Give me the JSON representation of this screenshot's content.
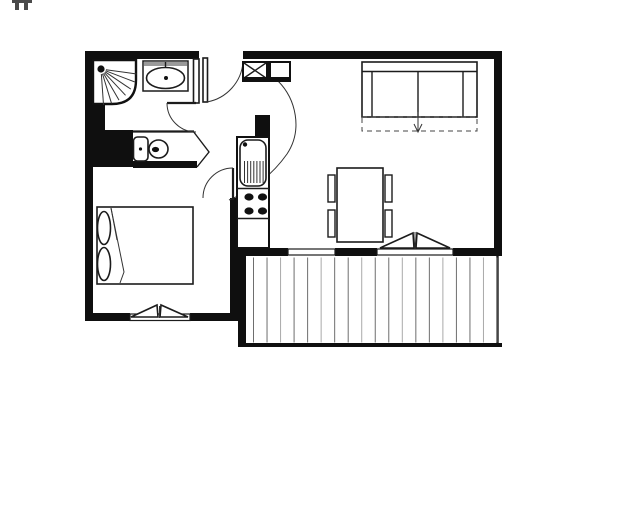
{
  "canvas": {
    "width": 640,
    "height": 524,
    "background": "#ffffff"
  },
  "palette": {
    "wall": "#0f0f0f",
    "line": "#1c1c1c",
    "soft_gray": "#8f8f8f",
    "board_dark": "#6e6e6e",
    "board_light": "#a9a9a9"
  },
  "corner_mark": {
    "present": true,
    "color": "#4a4a4a"
  },
  "plan": {
    "type": "apartment-floor-plan",
    "fixtures": [
      "shower",
      "washbasin",
      "toilet",
      "wardrobe",
      "entrance-door",
      "kitchen-sink",
      "stove",
      "counter",
      "sofa-bed",
      "dining-table",
      "chairs",
      "double-bed",
      "pillows",
      "casement-window",
      "french-door",
      "fixed-window",
      "balcony-deck"
    ],
    "balcony": {
      "board_count": 19,
      "x_start": 253.5,
      "x_end": 497,
      "y_top": 257.5,
      "y_bottom": 342.5,
      "alternate_shades": true
    },
    "stove": {
      "burner_count": 4,
      "burners": [
        [
          249,
          197
        ],
        [
          262.5,
          197
        ],
        [
          249,
          211
        ],
        [
          262.5,
          211
        ]
      ],
      "rx": 4.6,
      "ry": 3.6
    },
    "shower_rays": {
      "count": 7,
      "origin": [
        101,
        69
      ],
      "radius": 36,
      "angle_start_deg": 8,
      "angle_end_deg": 86
    },
    "sink_drainer": {
      "line_count": 7,
      "x_start": 244.5,
      "x_step": 3.1,
      "y_top": 161,
      "y_bottom": 183
    },
    "dining_chairs": {
      "count": 4,
      "positions": [
        [
          328,
          175
        ],
        [
          328,
          210
        ],
        [
          385,
          175
        ],
        [
          385,
          210
        ]
      ],
      "w": 7,
      "h": 27
    },
    "sofa": {
      "seat_count": 3,
      "convertible_arrow": true
    },
    "bed": {
      "pillow_count": 2
    }
  }
}
